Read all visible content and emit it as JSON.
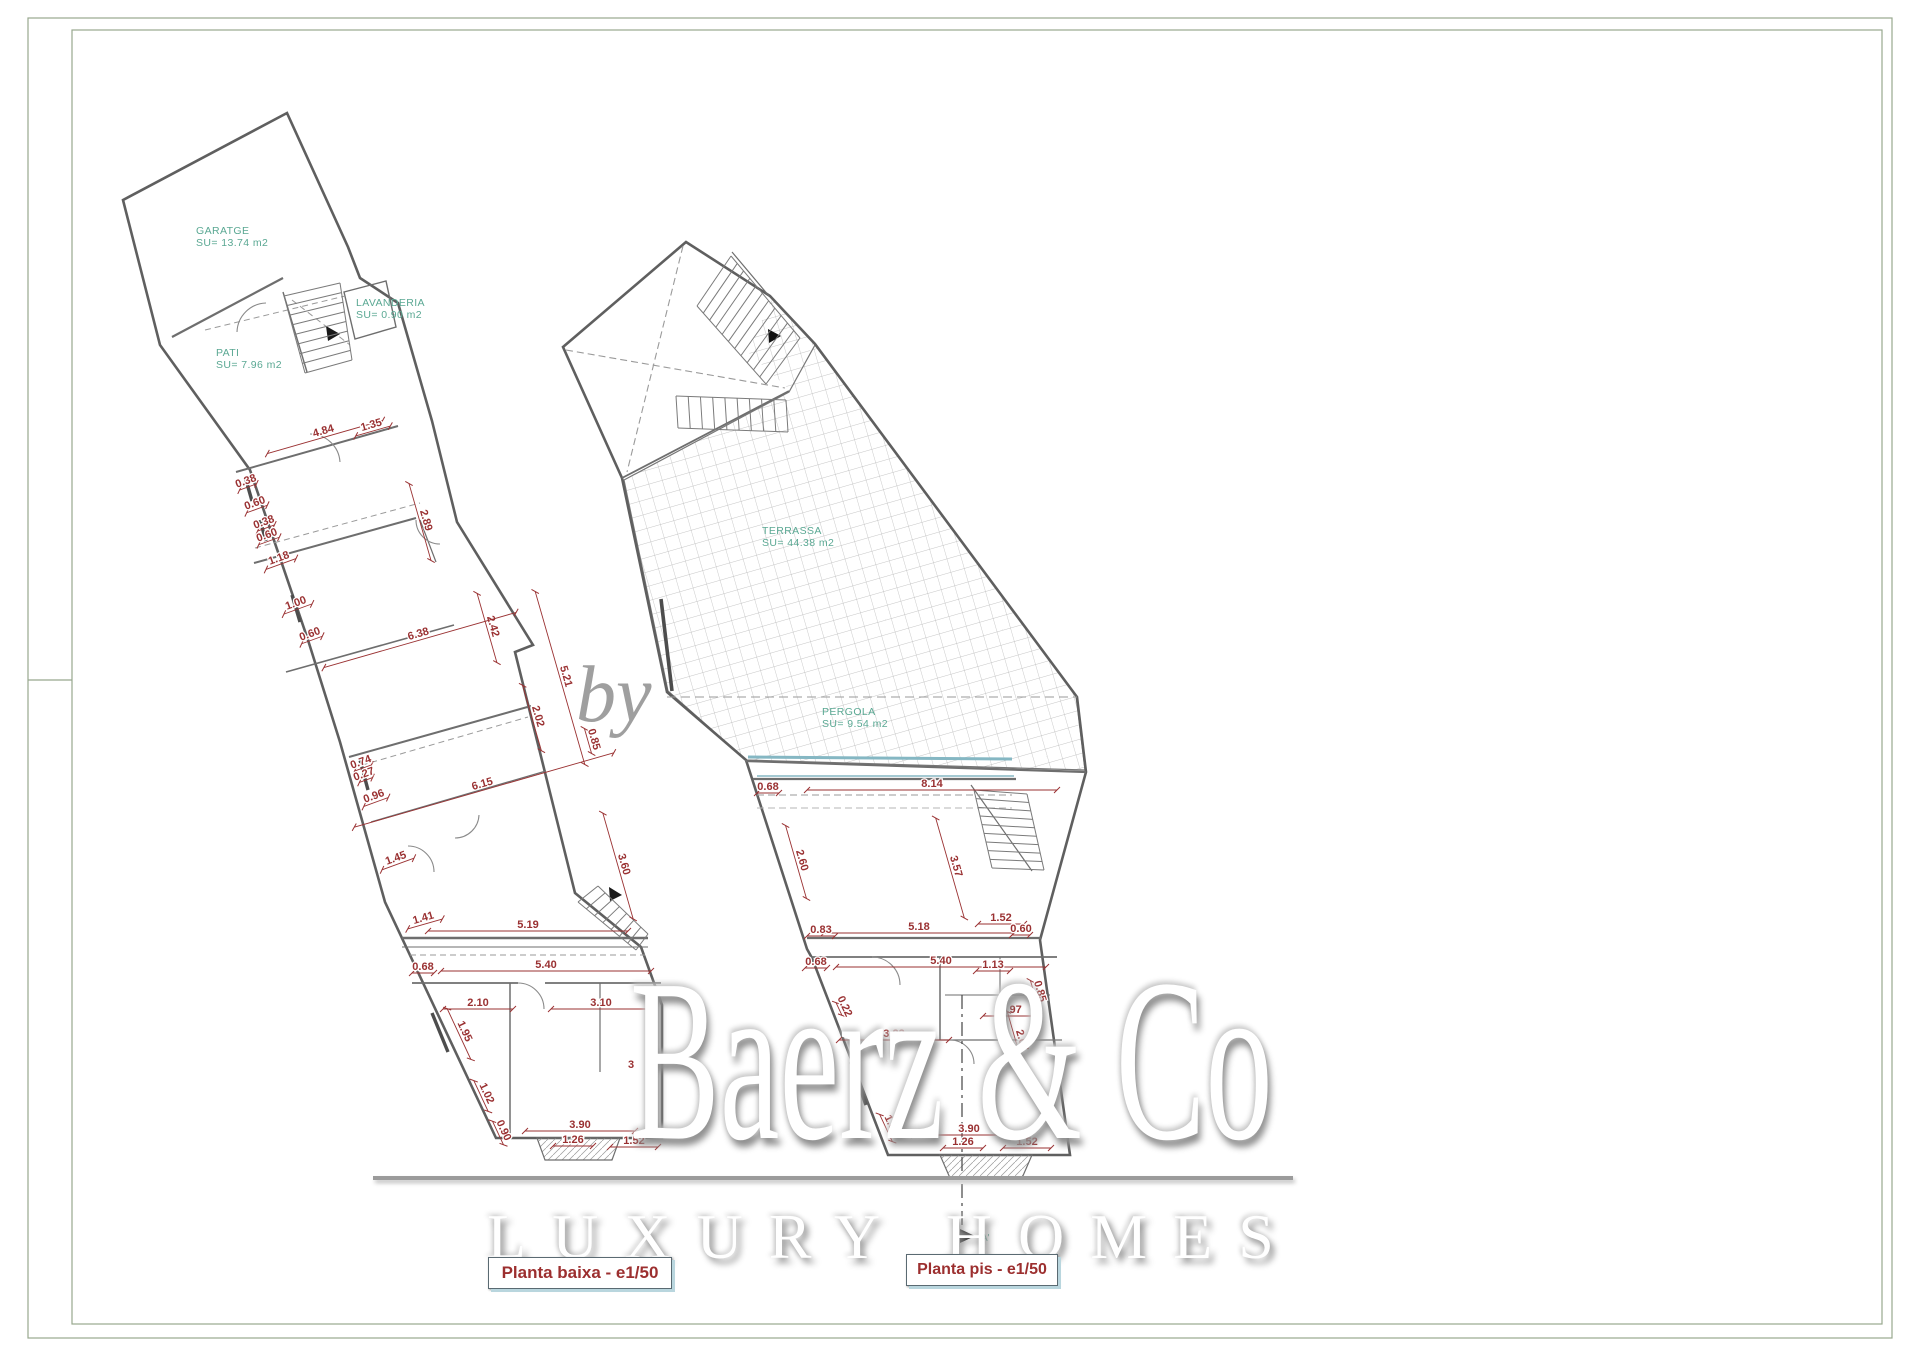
{
  "watermark": {
    "by": "by",
    "brand": "Baerz & Co",
    "tagline": "LUXURY HOMES"
  },
  "titles": [
    {
      "label": "Planta baixa - e1/50"
    },
    {
      "label": "Planta pis - e1/50"
    }
  ],
  "colors": {
    "dimension": "#9a3132",
    "room_label": "#5aa893",
    "walls": "#6a6a6a",
    "glazing": "#85b7c3",
    "frame": "#98a88e",
    "title_text": "#9c2f2f",
    "tile": "#b3b3b3"
  },
  "plans": [
    {
      "name": "Planta baixa",
      "scale": "e1/50",
      "rooms": [
        {
          "label": "GARATGE",
          "area": "SU= 13.74 m2",
          "x": 196,
          "y": 234
        },
        {
          "label": "PATI",
          "area": "SU= 7.96 m2",
          "x": 216,
          "y": 356
        },
        {
          "label": "LAVANDERIA",
          "area": "SU= 0.90 m2",
          "x": 356,
          "y": 306
        }
      ],
      "room_numbers": [
        {
          "label": "3",
          "x": 628,
          "y": 1068
        }
      ],
      "dimensions": [
        {
          "v": "4.84",
          "x": 325,
          "y": 437,
          "a": -16,
          "l": 60
        },
        {
          "v": "1.35",
          "x": 373,
          "y": 431,
          "a": -16,
          "l": 18
        },
        {
          "v": "0.38",
          "x": 248,
          "y": 487,
          "a": -20,
          "l": 9
        },
        {
          "v": "0.60",
          "x": 257,
          "y": 509,
          "a": -20,
          "l": 11
        },
        {
          "v": "0.38",
          "x": 266,
          "y": 528,
          "a": -20,
          "l": 9
        },
        {
          "v": "0.60",
          "x": 269,
          "y": 541,
          "a": -20,
          "l": 11
        },
        {
          "v": "1.18",
          "x": 281,
          "y": 564,
          "a": -20,
          "l": 16
        },
        {
          "v": "1.00",
          "x": 298,
          "y": 609,
          "a": -20,
          "l": 15
        },
        {
          "v": "0.60",
          "x": 312,
          "y": 640,
          "a": -20,
          "l": 11
        },
        {
          "v": "2.89",
          "x": 420,
          "y": 522,
          "a": 74,
          "l": 40
        },
        {
          "v": "2.42",
          "x": 487,
          "y": 628,
          "a": 74,
          "l": 36
        },
        {
          "v": "6.38",
          "x": 420,
          "y": 640,
          "a": -16,
          "l": 100
        },
        {
          "v": "5.21",
          "x": 560,
          "y": 678,
          "a": 74,
          "l": 90
        },
        {
          "v": "2.02",
          "x": 532,
          "y": 718,
          "a": 74,
          "l": 34
        },
        {
          "v": "0.85",
          "x": 588,
          "y": 741,
          "a": 74,
          "l": 13
        },
        {
          "v": "6.15",
          "x": 484,
          "y": 790,
          "a": -16,
          "l": 135
        },
        {
          "v": "0.74",
          "x": 363,
          "y": 768,
          "a": -20,
          "l": 9
        },
        {
          "v": "0.27",
          "x": 366,
          "y": 780,
          "a": -20,
          "l": 7
        },
        {
          "v": "0.96",
          "x": 376,
          "y": 802,
          "a": -20,
          "l": 13
        },
        {
          "v": "1.45",
          "x": 398,
          "y": 864,
          "a": -20,
          "l": 17
        },
        {
          "v": "3.60",
          "x": 618,
          "y": 866,
          "a": 74,
          "l": 55
        },
        {
          "v": "1.41",
          "x": 425,
          "y": 924,
          "a": -16,
          "l": 18
        },
        {
          "v": "5.19",
          "x": 528,
          "y": 931,
          "a": 0,
          "l": 100
        },
        {
          "v": "0.68",
          "x": 423,
          "y": 973,
          "a": 0,
          "l": 11
        },
        {
          "v": "5.40",
          "x": 546,
          "y": 971,
          "a": 0,
          "l": 105
        },
        {
          "v": "2.10",
          "x": 478,
          "y": 1009,
          "a": 0,
          "l": 35
        },
        {
          "v": "3.10",
          "x": 601,
          "y": 1009,
          "a": 0,
          "l": 50
        },
        {
          "v": "1.95",
          "x": 459,
          "y": 1034,
          "a": 65,
          "l": 28
        },
        {
          "v": "1.02",
          "x": 481,
          "y": 1096,
          "a": 65,
          "l": 17
        },
        {
          "v": "0.90",
          "x": 498,
          "y": 1133,
          "a": 65,
          "l": 13
        },
        {
          "v": "3.90",
          "x": 580,
          "y": 1131,
          "a": 0,
          "l": 55
        },
        {
          "v": "1.26",
          "x": 573,
          "y": 1146,
          "a": 0,
          "l": 20
        },
        {
          "v": "1.52",
          "x": 634,
          "y": 1147,
          "a": 0,
          "l": 24
        }
      ]
    },
    {
      "name": "Planta pis",
      "scale": "e1/50",
      "rooms": [
        {
          "label": "TERRASSA",
          "area": "SU= 44.38 m2",
          "x": 762,
          "y": 534
        },
        {
          "label": "PERGOLA",
          "area": "SU= 9.54 m2",
          "x": 822,
          "y": 715
        }
      ],
      "room_numbers": [],
      "dimensions": [
        {
          "v": "0.68",
          "x": 768,
          "y": 793,
          "a": 0,
          "l": 11
        },
        {
          "v": "8.14",
          "x": 932,
          "y": 790,
          "a": 0,
          "l": 125
        },
        {
          "v": "2.60",
          "x": 796,
          "y": 862,
          "a": 74,
          "l": 38
        },
        {
          "v": "3.57",
          "x": 950,
          "y": 868,
          "a": 74,
          "l": 52
        },
        {
          "v": "5.18",
          "x": 919,
          "y": 933,
          "a": 0,
          "l": 95
        },
        {
          "v": "0.83",
          "x": 821,
          "y": 936,
          "a": 0,
          "l": 14
        },
        {
          "v": "1.52",
          "x": 1001,
          "y": 924,
          "a": 0,
          "l": 23
        },
        {
          "v": "0.60",
          "x": 1021,
          "y": 935,
          "a": 0,
          "l": 9
        },
        {
          "v": "0.68",
          "x": 816,
          "y": 968,
          "a": 0,
          "l": 11
        },
        {
          "v": "5.40",
          "x": 941,
          "y": 967,
          "a": 0,
          "l": 105
        },
        {
          "v": "1.13",
          "x": 993,
          "y": 971,
          "a": 0,
          "l": 17
        },
        {
          "v": "0.85",
          "x": 1034,
          "y": 993,
          "a": 74,
          "l": 13
        },
        {
          "v": "1.97",
          "x": 1011,
          "y": 1016,
          "a": 0,
          "l": 28
        },
        {
          "v": "2.07",
          "x": 1016,
          "y": 1042,
          "a": 74,
          "l": 32
        },
        {
          "v": "0.22",
          "x": 839,
          "y": 1009,
          "a": 65,
          "l": 7
        },
        {
          "v": "3.23",
          "x": 894,
          "y": 1040,
          "a": 0,
          "l": 55
        },
        {
          "v": "1.00",
          "x": 886,
          "y": 1128,
          "a": 65,
          "l": 15
        },
        {
          "v": "3.90",
          "x": 969,
          "y": 1135,
          "a": 0,
          "l": 55
        },
        {
          "v": "1.26",
          "x": 963,
          "y": 1148,
          "a": 0,
          "l": 20
        },
        {
          "v": "1.52",
          "x": 1027,
          "y": 1148,
          "a": 0,
          "l": 24
        }
      ],
      "section_marker": {
        "label": "A'",
        "x": 981,
        "y": 1241
      }
    }
  ]
}
